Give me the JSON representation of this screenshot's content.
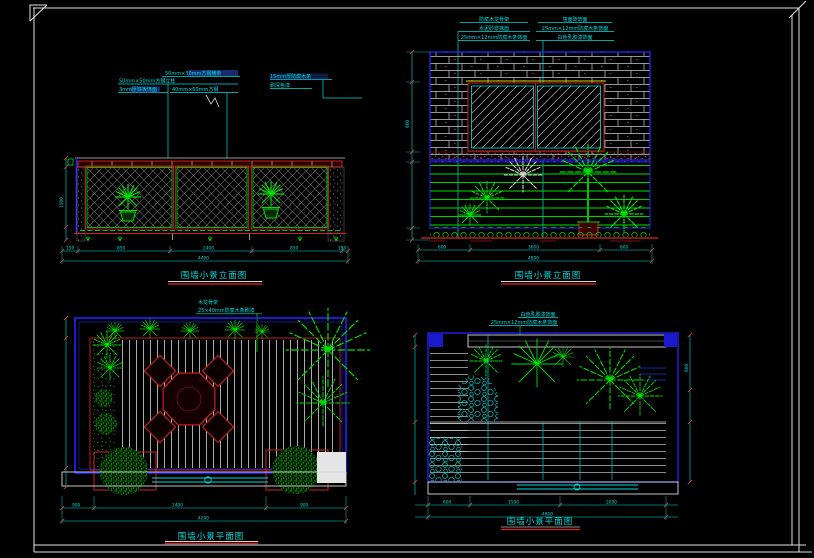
{
  "document": {
    "type": "cad-drawing-sheet",
    "background": "#000000",
    "frame_color": "#e0e0e0"
  },
  "colors": {
    "cyan": "#00dcdc",
    "green": "#00d400",
    "bright_green": "#00ff00",
    "red": "#e02020",
    "blue": "#2424ff",
    "yellow": "#d6d600",
    "white": "#e0e0e0",
    "hatch_gray": "#6f6f6f"
  },
  "panelA": {
    "title": "围墙小景立面图",
    "annotations": {
      "a0": "50mm×30mm方钢横条",
      "a1": "50mm×50mm方钢立柱",
      "a2": "3mm厚铁板饰面",
      "a3": "40mm×60mm方钢",
      "r0": "15mm厚防腐木条",
      "r1": "刷深色漆"
    },
    "dims": {
      "s0": "150",
      "s1": "850",
      "s2": "2400",
      "s3": "850",
      "s4": "150",
      "total": "4400",
      "v0": "1500"
    }
  },
  "panelB": {
    "title": "围墙小景立面图",
    "left_note": {
      "0": "防腐木龙骨架",
      "1": "水泥砂浆抹面",
      "2": "25mm×12mm防腐木条饰面"
    },
    "right_note": {
      "0": "墙面砖饰面",
      "1": "25mm×12mm防腐木条饰面",
      "2": "白色乳胶漆饰面"
    },
    "dims": {
      "s0": "600",
      "s1": "3600",
      "s2": "600",
      "total": "4800",
      "v0": "900"
    }
  },
  "panelC": {
    "title": "围墙小景平面图",
    "note": {
      "0": "木龙骨架",
      "1": "25×40mm防腐木条刷漆"
    },
    "dims": {
      "s0": "900",
      "s1": "2400",
      "s2": "900",
      "total": "4200"
    }
  },
  "panelD": {
    "title": "围墙小景平面图",
    "note": {
      "0": "白色乳胶漆饰面",
      "1": "25mm×12mm防腐木条饰面"
    },
    "dims": {
      "s0": "600",
      "s1": "1500",
      "s2": "2000",
      "total": "4800",
      "v0": "900"
    }
  }
}
